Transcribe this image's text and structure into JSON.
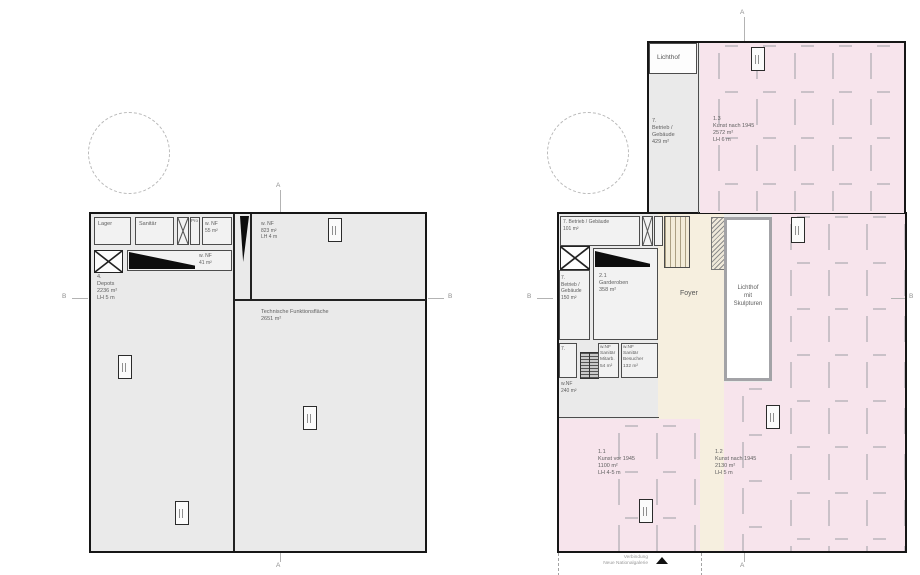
{
  "markers": {
    "a": "A",
    "b": "B"
  },
  "colors": {
    "plan_fill": "#eaeaea",
    "gallery_pink": "#f7e4ec",
    "foyer_beige": "#f6efdf",
    "wall": "#161616",
    "partition": "#b6b2b8"
  },
  "plan_left": {
    "rooms": {
      "lager": "Lager",
      "sanitaer": "Sanitär",
      "pro": "Pro",
      "nf55": "w. NF\n55 m²",
      "nf823": "w. NF\n823 m²\nLH 4 m",
      "nf41": "w. NF\n41 m²",
      "depots": "4.\nDepots\n2236 m²\nLH 5 m",
      "technik": "Technische Funktionsfläche\n2651 m²"
    }
  },
  "plan_right": {
    "rooms": {
      "lichthof": "Lichthof",
      "betrieb429": "7.\nBetrieb /\nGebäude\n429 m²",
      "kunst13": "1.3\nKunst nach 1945\n2572 m²\nLH 6 m",
      "betrieb101": "7. Betrieb / Gebäude\n101 m²",
      "betrieb150": "7.\nBetrieb /\nGebäude\n150 m²",
      "garderoben": "2.1\nGarderoben\n358 m²",
      "foyer": "Foyer",
      "lichthof_skulpturen": "Lichthof\nmit\nSkulpturen",
      "sieben": "7.",
      "sanitaer_mitarb": "w.NF\nSanitär\nMitarb.\n54 m²",
      "sanitaer_besucher": "w.NF\nSanitär\nBesucher\n132 m²",
      "nf240": "w.NF\n240 m²",
      "kunst11": "1.1\nKunst vor 1945\n1100 m²\nLH 4-5 m",
      "kunst12": "1.2\nKunst nach 1945\n2130 m²\nLH 5 m"
    },
    "verbindung": "Verbindung\nNeue Nationalgalerie"
  }
}
